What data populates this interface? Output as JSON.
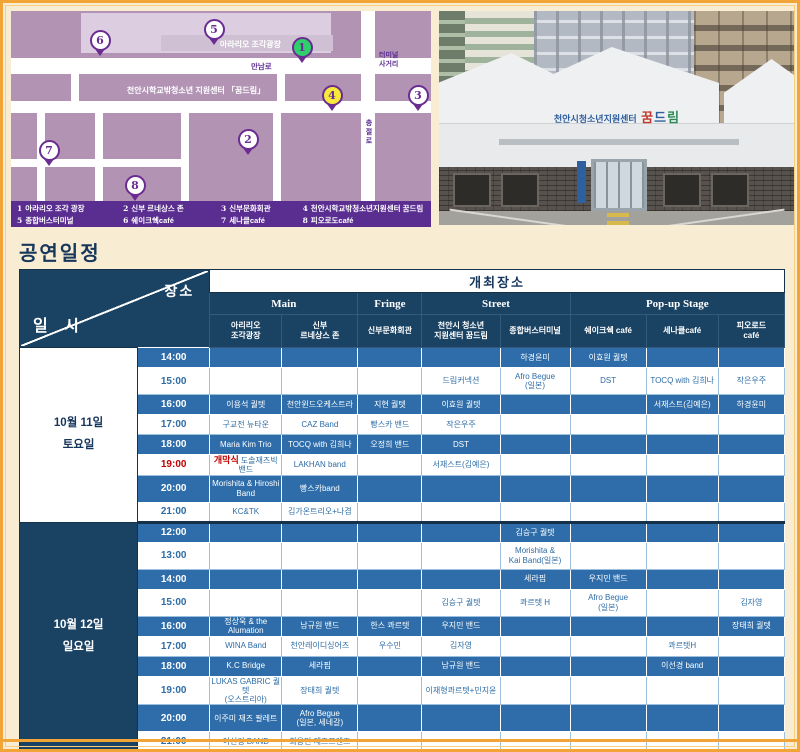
{
  "page": {
    "title": "공연일정"
  },
  "colors": {
    "navy": "#1a4263",
    "row_blue": "#2e6daa",
    "accent_red": "#c00000",
    "legend_purple": "#5a2d91",
    "frame_orange": "#f2a437",
    "map_mauve": "#c4a7c6"
  },
  "map": {
    "labels": {
      "plaza": "아라리오 조각광장",
      "mannam_ro": "만남로",
      "terminal_cross": "터미널\n사거리",
      "center": "천안시학교밖청소년 지원센터 「꿈드림」",
      "chungjeol_ro": "충절로"
    },
    "markers": [
      {
        "num": "1",
        "style": "green"
      },
      {
        "num": "2",
        "style": "white"
      },
      {
        "num": "3",
        "style": "white"
      },
      {
        "num": "4",
        "style": "yellow"
      },
      {
        "num": "5",
        "style": "white"
      },
      {
        "num": "6",
        "style": "white"
      },
      {
        "num": "7",
        "style": "white"
      },
      {
        "num": "8",
        "style": "white"
      }
    ],
    "legend": [
      {
        "num": "1",
        "label": "아라리오 조각 광장"
      },
      {
        "num": "2",
        "label": "신부 르네상스 존"
      },
      {
        "num": "3",
        "label": "신부문화회관"
      },
      {
        "num": "4",
        "label": "천안시학교밖청소년지원센터 꿈드림"
      },
      {
        "num": "5",
        "label": "종합버스터미널"
      },
      {
        "num": "6",
        "label": "쉐이크쉑café"
      },
      {
        "num": "7",
        "label": "세나클café"
      },
      {
        "num": "8",
        "label": "피오로도café"
      }
    ]
  },
  "photo": {
    "sign_prefix": "천안시청소년지원센터",
    "sign_name": "꿈드림"
  },
  "table": {
    "corner": {
      "top": "장소",
      "bottom": "일 시"
    },
    "banner": "개최장소",
    "groups": [
      {
        "label": "Main"
      },
      {
        "label": "Fringe"
      },
      {
        "label": "Street"
      },
      {
        "label": "Pop-up Stage"
      }
    ],
    "venues": [
      "아리리오\n조각광장",
      "신부\n르네상스 존",
      "신부문화회관",
      "천안시 청소년\n지원센터 꿈드림",
      "종합버스터미널",
      "쉐이크쉑 café",
      "세나클café",
      "피오로드\ncafé"
    ],
    "days": [
      {
        "label": "10월 11일\n토요일",
        "style": "light",
        "rows": [
          {
            "time": "14:00",
            "cells": [
              "",
              "",
              "",
              "",
              "하경윤미",
              "이효원 퀄텟",
              "",
              ""
            ]
          },
          {
            "time": "15:00",
            "cells": [
              "",
              "",
              "",
              "드림커넥션",
              "Afro Begue\n(일본)",
              "DST",
              "TOCQ with 김희나",
              "작은우주"
            ]
          },
          {
            "time": "16:00",
            "cells": [
              "이용석 퀄텟",
              "천안윈드오케스트라",
              "지현 퀄텟",
              "이효원 퀄텟",
              "",
              "",
              "서재스트(김예은)",
              "하경윤미"
            ]
          },
          {
            "time": "17:00",
            "cells": [
              "구교전 뉴타운",
              "CAZ Band",
              "빵스카 밴드",
              "작은우주",
              "",
              "",
              "",
              ""
            ]
          },
          {
            "time": "18:00",
            "cells": [
              "Maria Kim Trio",
              "TOCQ with 김희나",
              "오정희 밴드",
              "DST",
              "",
              "",
              "",
              ""
            ]
          },
          {
            "time": "19:00",
            "time_red": true,
            "cells": [
              {
                "red": "개막식",
                "text": "도솔재즈빅밴드"
              },
              "LAKHAN band",
              "",
              "서재스트(김예은)",
              "",
              "",
              "",
              ""
            ]
          },
          {
            "time": "20:00",
            "cells": [
              "Morishita & Hiroshi\nBand",
              "빵스카band",
              "",
              "",
              "",
              "",
              "",
              ""
            ]
          },
          {
            "time": "21:00",
            "cells": [
              "KC&TK",
              "김가온트리오+나겸",
              "",
              "",
              "",
              "",
              "",
              ""
            ]
          }
        ]
      },
      {
        "label": "10월 12일\n일요일",
        "style": "dark",
        "rows": [
          {
            "time": "12:00",
            "cells": [
              "",
              "",
              "",
              "",
              "김승구 퀄텟",
              "",
              "",
              ""
            ]
          },
          {
            "time": "13:00",
            "cells": [
              "",
              "",
              "",
              "",
              "Morishita &\nKai Band(일본)",
              "",
              "",
              ""
            ]
          },
          {
            "time": "14:00",
            "cells": [
              "",
              "",
              "",
              "",
              "세라핌",
              "우지민 밴드",
              "",
              ""
            ]
          },
          {
            "time": "15:00",
            "cells": [
              "",
              "",
              "",
              "김승구 퀄텟",
              "콰르텟 H",
              "Afro Begue\n(일본)",
              "",
              "김자영"
            ]
          },
          {
            "time": "16:00",
            "cells": [
              "정상욱 & the Alumation",
              "남규원 밴드",
              "한스 콰르텟",
              "우지민 밴드",
              "",
              "",
              "",
              "장태희 퀄텟"
            ]
          },
          {
            "time": "17:00",
            "cells": [
              "WINA Band",
              "천안레이디싱어즈",
              "우수민",
              "김자영",
              "",
              "",
              "콰르텟H",
              ""
            ]
          },
          {
            "time": "18:00",
            "cells": [
              "K.C Bridge",
              "세라핌",
              "",
              "남규원 밴드",
              "",
              "",
              "이선경 band",
              ""
            ]
          },
          {
            "time": "19:00",
            "cells": [
              "LUKAS GABRIC 퀄텟\n(오스트리아)",
              "장태희 퀄텟",
              "",
              "이재형콰르텟+민지윤",
              "",
              "",
              "",
              ""
            ]
          },
          {
            "time": "20:00",
            "cells": [
              "이주미 재즈 팔레트",
              "Afro Begue\n(일본, 세네갈)",
              "",
              "",
              "",
              "",
              "",
              ""
            ]
          },
          {
            "time": "21:00",
            "cells": [
              "이선경 BAND",
              "최용민 재즈프렌즈",
              "",
              "",
              "",
              "",
              "",
              ""
            ]
          }
        ]
      }
    ]
  }
}
